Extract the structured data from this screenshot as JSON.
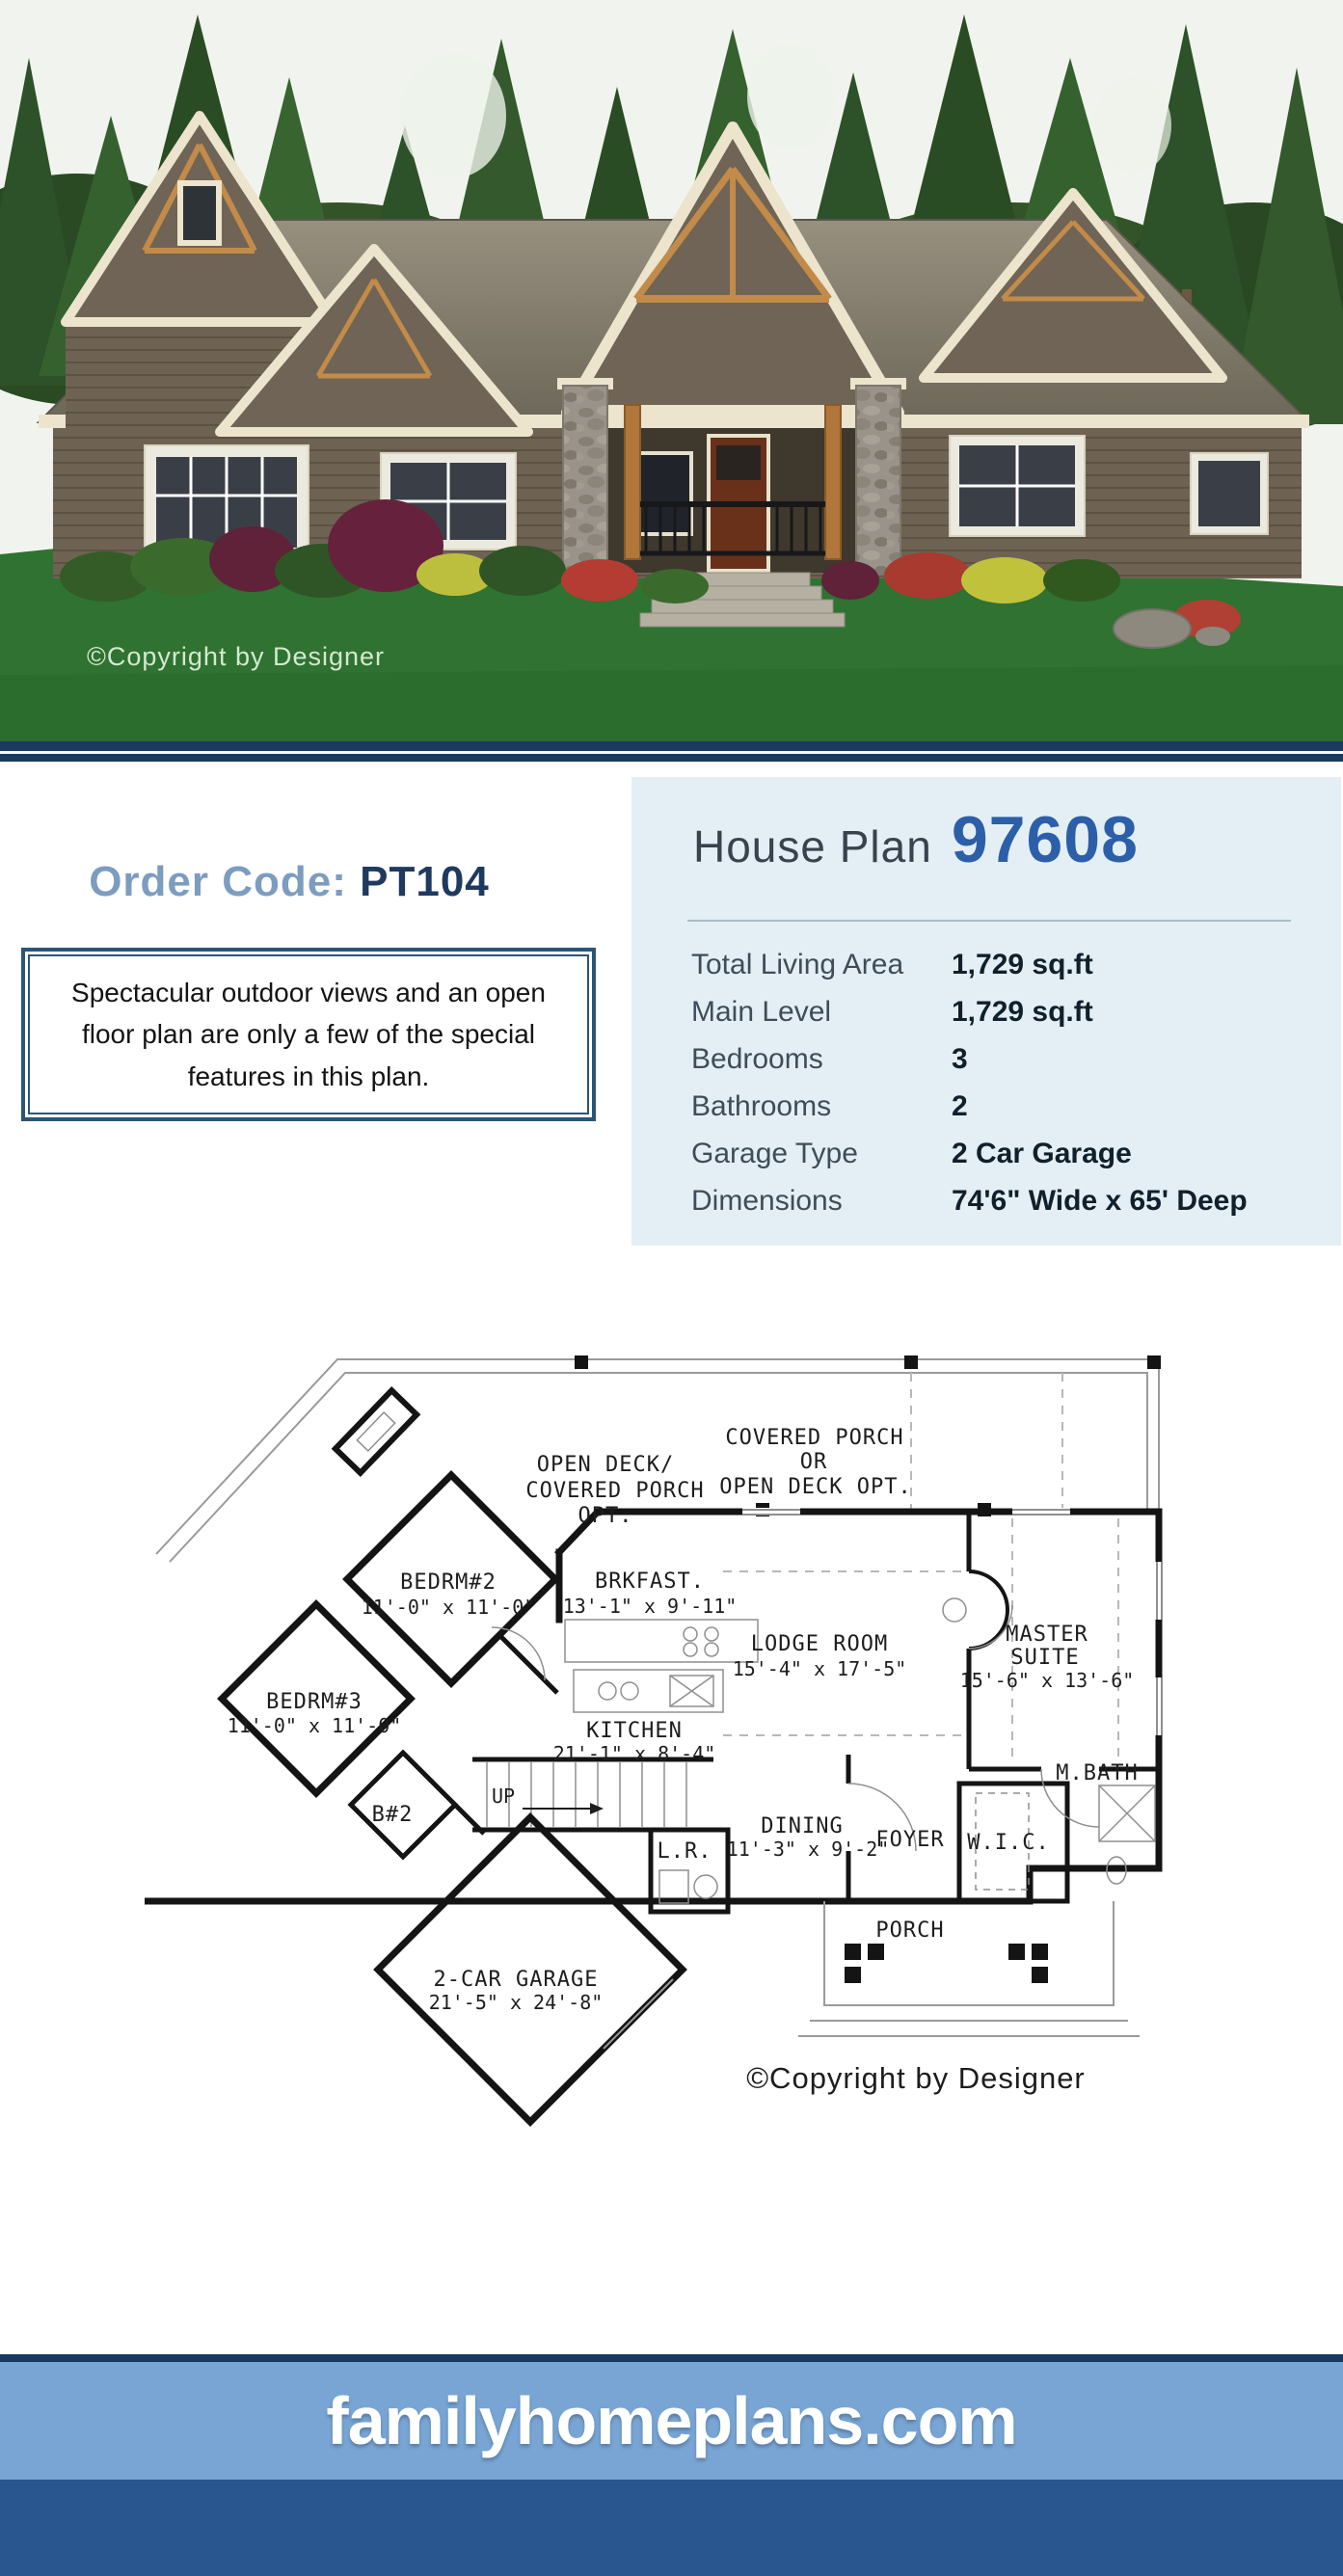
{
  "photo": {
    "copyright": "©Copyright by Designer"
  },
  "order": {
    "label": "Order Code:",
    "code": "PT104"
  },
  "description": "Spectacular outdoor views and an open floor plan are only a few of the special features in this plan.",
  "plan_header": {
    "prefix": "House Plan",
    "number": "97608"
  },
  "specs": {
    "rows": [
      {
        "label": "Total Living Area",
        "value": "1,729 sq.ft"
      },
      {
        "label": "Main Level",
        "value": "1,729 sq.ft"
      },
      {
        "label": "Bedrooms",
        "value": "3"
      },
      {
        "label": "Bathrooms",
        "value": "2"
      },
      {
        "label": "Garage Type",
        "value": "2 Car Garage"
      },
      {
        "label": "Dimensions",
        "value": "74'6\" Wide x 65' Deep"
      }
    ]
  },
  "floorplan": {
    "copyright": "©Copyright by Designer",
    "labels": {
      "open_deck_1": "OPEN DECK/",
      "open_deck_2": "COVERED PORCH",
      "open_deck_3": "OPT.",
      "covered_porch_1": "COVERED PORCH",
      "covered_porch_2": "OR",
      "covered_porch_3": "OPEN DECK OPT.",
      "bedrm2_name": "BEDRM#2",
      "bedrm2_dims": "11'-0\" x 11'-0\"",
      "brkfast_name": "BRKFAST.",
      "brkfast_dims": "13'-1\" x 9'-11\"",
      "lodge_name": "LODGE ROOM",
      "lodge_dims": "15'-4\" x 17'-5\"",
      "master_1": "MASTER",
      "master_2": "SUITE",
      "master_dims": "15'-6\" x 13'-6\"",
      "bedrm3_name": "BEDRM#3",
      "bedrm3_dims": "11'-0\" x 11'-0\"",
      "kitchen_name": "KITCHEN",
      "kitchen_dims": "21'-1\" x 8'-4\"",
      "mbath": "M.BATH",
      "b2": "B#2",
      "up": "UP",
      "dining_name": "DINING",
      "dining_dims": "11'-3\" x 9'-2\"",
      "foyer": "FOYER",
      "wic": "W.I.C.",
      "lr": "L.R.",
      "porch": "PORCH",
      "garage_name": "2-CAR GARAGE",
      "garage_dims": "21'-5\" x 24'-8\""
    }
  },
  "footer": {
    "site": "familyhomeplans.com"
  },
  "colors": {
    "navy": "#1b3a5f",
    "panel_bg": "#e3eff4",
    "plan_number_blue": "#2c5fa8",
    "order_label_blue": "#7c9cc0",
    "footer_light": "#78a5d3",
    "footer_dark": "#2a568f"
  }
}
